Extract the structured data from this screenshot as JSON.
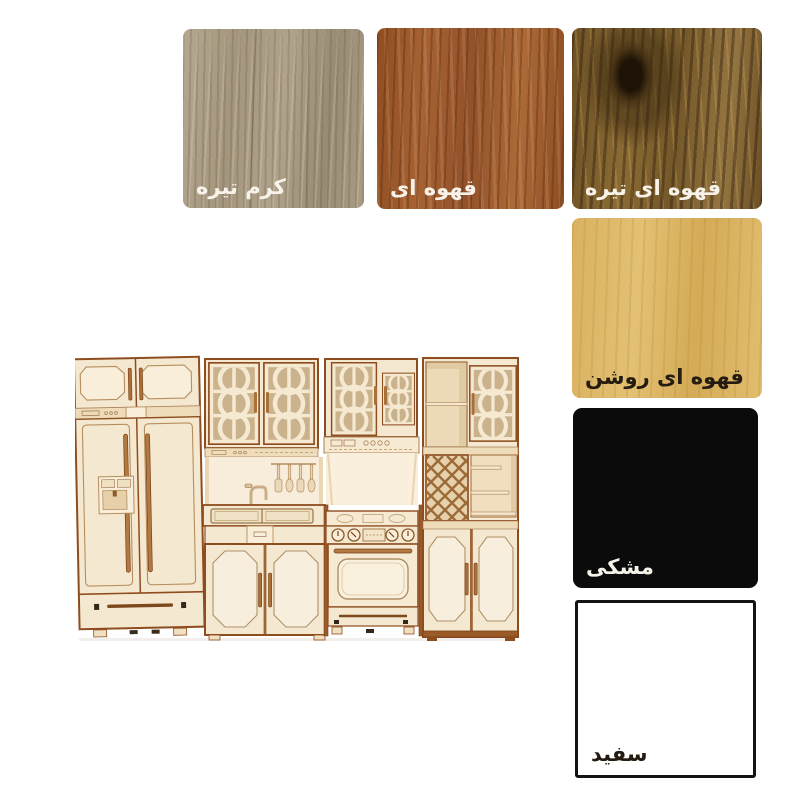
{
  "canvas": {
    "background": "#ffffff"
  },
  "product_image": {
    "alt": "miniature laser-cut plywood toy kitchen set (fridge, glass-front cabinets, sink, stove-oven, wine rack, tall cabinet)",
    "wood_color": "#f5e8d0",
    "edge_color": "#8e4d1f"
  },
  "swatches": [
    {
      "id": "dark-cream",
      "label": "کرم تیره",
      "base_color": "#aa9c85",
      "label_color": "#f8f3ea"
    },
    {
      "id": "brown",
      "label": "قهوه ای",
      "base_color": "#9b592b",
      "label_color": "#f8f3ea"
    },
    {
      "id": "dark-brown",
      "label": "قهوه ای تیره",
      "base_color": "#7b5c2c",
      "label_color": "#f8f3ea"
    },
    {
      "id": "light-brown",
      "label": "قهوه ای روشن",
      "base_color": "#dbb565",
      "label_color": "#241c10"
    },
    {
      "id": "black",
      "label": "مشکی",
      "base_color": "#0b0b0b",
      "label_color": "#f8f3ea"
    },
    {
      "id": "white",
      "label": "سفید",
      "base_color": "#ffffff",
      "border_color": "#131313",
      "label_color": "#241c10"
    }
  ]
}
